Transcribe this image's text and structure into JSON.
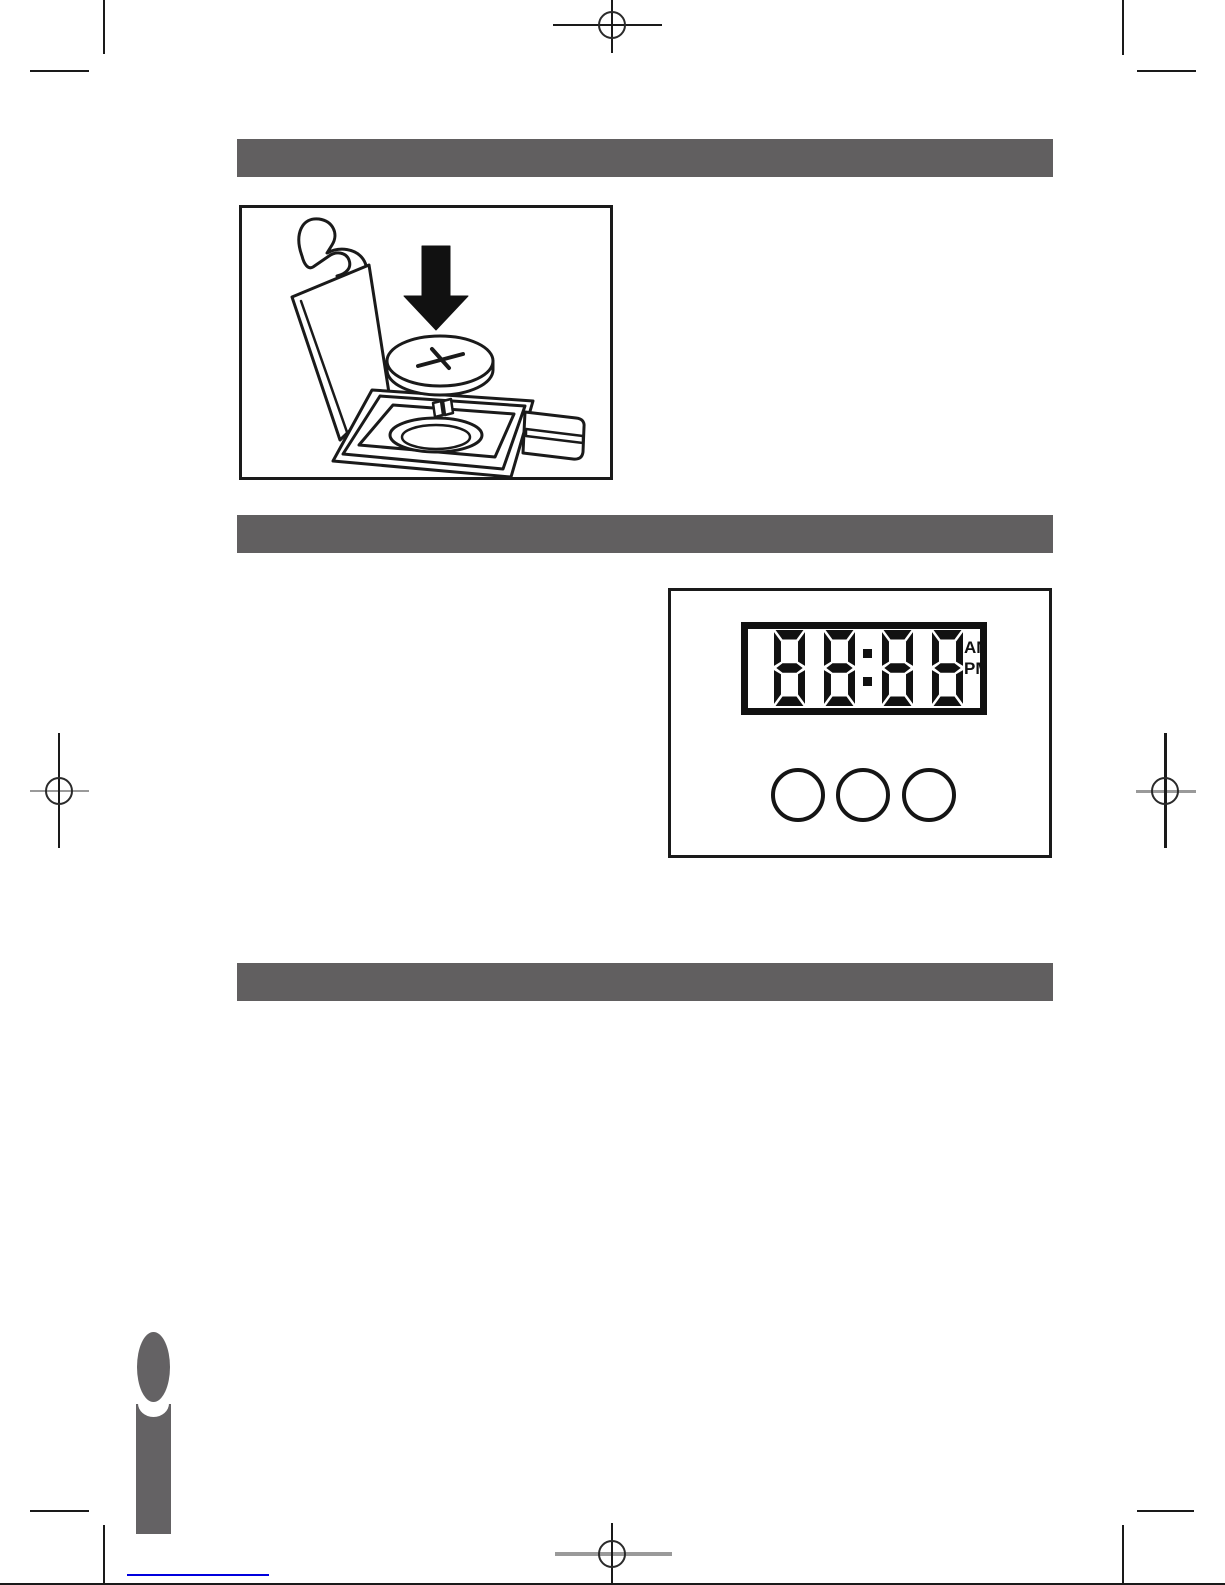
{
  "document": {
    "kind": "instruction-manual-page"
  },
  "sections": {
    "bars": [
      {
        "label": ""
      },
      {
        "label": ""
      },
      {
        "label": ""
      }
    ]
  },
  "battery_figure": {
    "polarity_symbol": "+"
  },
  "clock_figure": {
    "display_value": "88:88",
    "am_label": "AM",
    "pm_label": "PM",
    "button_count": 3
  },
  "colors": {
    "section_bar": "#615f60",
    "info_icon": "#646264",
    "link_blue": "#0000dd",
    "ink": "#111111"
  }
}
